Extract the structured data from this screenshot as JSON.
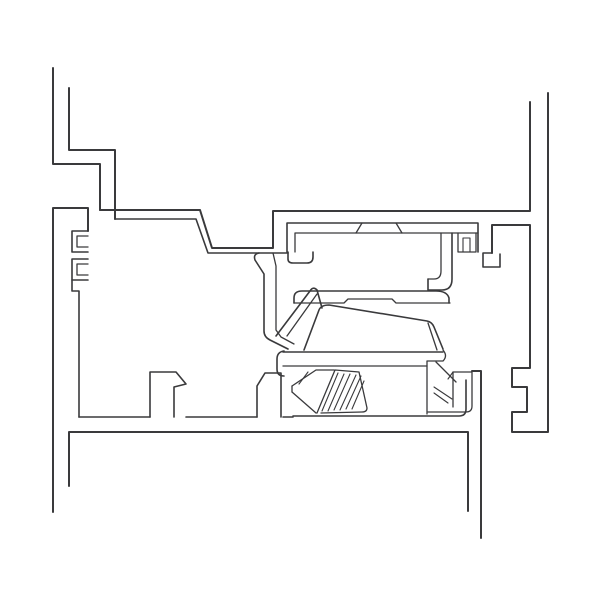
{
  "page": {
    "title": "",
    "background_color": "#ffffff"
  },
  "drawing": {
    "description-name": "window-frame-cross-section",
    "background": "#ffffff",
    "stroke_color": "#3a3a3c",
    "default_stroke_width": 1.7,
    "canvas": {
      "width": 600,
      "height": 600
    },
    "paths": [
      {
        "name": "sash-top-left-outer-wall",
        "d": "M53,68 V164 H100 V210",
        "w": 2
      },
      {
        "name": "sash-top-left-inner-wall",
        "d": "M69,88 V150 H115 V219",
        "w": 2
      },
      {
        "name": "sash-shelf-top-surface",
        "d": "M100,210 H200 L212,248 H273 V211 H530 V102",
        "w": 2
      },
      {
        "name": "sash-shelf-bottom-surface",
        "d": "M115,219 H196 L208,253 H288",
        "w": 1.6
      },
      {
        "name": "frame-left-outer-wall",
        "d": "M53,512 V208 H88 V231",
        "w": 2
      },
      {
        "name": "frame-left-screw-channel-upper",
        "d": "M88,231 H72 V252 H88",
        "w": 1.6
      },
      {
        "name": "frame-left-screw-channel-upper-inner",
        "d": "M88,247 H77 V236 H88",
        "w": 1.3
      },
      {
        "name": "frame-left-screw-channel-lower",
        "d": "M88,259 H72 V280 H88",
        "w": 1.6
      },
      {
        "name": "frame-left-screw-channel-lower-inner",
        "d": "M88,275 H77 V264 H88",
        "w": 1.3
      },
      {
        "name": "frame-left-web",
        "d": "M72,280 V291 H79 V417",
        "w": 1.6
      },
      {
        "name": "frame-bottom-floor",
        "d": "M79,417 H150 M186,417 H257 M283,417 H293",
        "w": 1.6
      },
      {
        "name": "glazing-tab-left",
        "d": "M150,417 V372 H176 L186,384 L174,387 V417",
        "w": 1.6
      },
      {
        "name": "glazing-tab-right",
        "d": "M257,417 V386 L265,373 H281 V417",
        "w": 1.6
      },
      {
        "name": "sill-bottom-profile",
        "d": "M69,486 V432 H468 V511",
        "w": 2
      },
      {
        "name": "frame-right-outer-wall",
        "d": "M548,93 V432 H512 V412 H527 V387 H512 V368 H530 V225 H492 V253",
        "w": 2
      },
      {
        "name": "frame-right-foot",
        "d": "M492,253 H483 V267 H500 V254",
        "w": 1.6
      },
      {
        "name": "keeper-plate-outline",
        "d": "M287,252 V223 H478 V252",
        "w": 1.6
      },
      {
        "name": "keeper-plate-underside",
        "d": "M295,252 V233 H478",
        "w": 1.3
      },
      {
        "name": "keeper-plate-pad",
        "d": "M356,233 L362,223 M396,223 L402,233",
        "w": 1.3
      },
      {
        "name": "keeper-lip",
        "d": "M288,252 V259 Q288,263 293,263 H307 Q313,263 313,257 V252",
        "w": 1.6
      },
      {
        "name": "keeper-screw-boss",
        "d": "M458,233 V252 H476 V233",
        "w": 1.3
      },
      {
        "name": "keeper-screw-boss-inner",
        "d": "M463,252 V238 H470 V252",
        "w": 1.1
      },
      {
        "name": "keeper-hook-outer",
        "d": "M452,233 V279 Q452,290 442,290 H428 V279",
        "w": 1.6
      },
      {
        "name": "keeper-hook-inner",
        "d": "M441,233 V271 Q441,279 434,279 H428",
        "w": 1.3
      },
      {
        "name": "lock-cover-top",
        "d": "M294,303 V298 Q294,291 302,291 H436 Q447,291 449,298 V303",
        "w": 1.6
      },
      {
        "name": "lock-cover-bottom-edge",
        "d": "M294,303 H344 L348,299 H392 L396,303 H450",
        "w": 1.3
      },
      {
        "name": "lock-arm-outer",
        "d": "M259,253 Q253,254 255,260 L264,274 V331 Q264,337 270,340 L288,349",
        "w": 1.6
      },
      {
        "name": "lock-arm-inner",
        "d": "M273,253 L276,266 V330 L281,337 L294,344",
        "w": 1.3
      },
      {
        "name": "latch-hook-edge",
        "d": "M276,336 L310,291 Q313,286 317,290 L322,308",
        "w": 1.6
      },
      {
        "name": "latch-hook-inner-edge",
        "d": "M287,336 L317,294",
        "w": 1.3
      },
      {
        "name": "latch-bolt",
        "d": "M304,350 L319,310 Q321,305 329,305 L427,321 Q432,322 434,327 L443,349",
        "w": 1.6
      },
      {
        "name": "latch-bolt-edge-line",
        "d": "M428,323 L437,350",
        "w": 1.3
      },
      {
        "name": "lock-base-top",
        "d": "M283,352 H443",
        "w": 1.6
      },
      {
        "name": "lock-base-lower",
        "d": "M283,366 H427",
        "w": 1.3
      },
      {
        "name": "lock-base-left-cap",
        "d": "M284,351 Q277,352 277,359 V369 Q277,376 284,376",
        "w": 1.6
      },
      {
        "name": "wedge-upper-edge",
        "d": "M292,386 L316,370 H334",
        "w": 1.3
      },
      {
        "name": "wedge-lower-edge",
        "d": "M292,392 L316,413",
        "w": 1.3
      },
      {
        "name": "wedge-tip",
        "d": "M292,386 V392",
        "w": 1.3
      },
      {
        "name": "wedge-inner-line",
        "d": "M299,384 L308,372",
        "w": 1.1
      },
      {
        "name": "hatch-block-outline",
        "d": "M317,413 L335,370 L359,372 L367,408 Q367,412 362,412 L321,413",
        "w": 1.3
      },
      {
        "name": "hatch-lines",
        "d": "M322,411 L338,373 M328,411 L344,374 M334,410 L350,374 M340,410 L356,375 M346,409 L361,376 M352,409 L364,381",
        "w": 1.1
      },
      {
        "name": "bolt-landing",
        "d": "M443,350 Q448,356 443,361 H427 V414",
        "w": 1.3
      },
      {
        "name": "support-diagonal-edge",
        "d": "M436,362 L456,382",
        "w": 1.3
      },
      {
        "name": "support-hatch-1",
        "d": "M434,387 L452,399",
        "w": 1.1
      },
      {
        "name": "support-hatch-2",
        "d": "M434,393 L448,403",
        "w": 1.1
      },
      {
        "name": "support-flag",
        "d": "M453,407 V372 H472 V406 Q472,412 466,412 H428",
        "w": 1.3
      },
      {
        "name": "support-flag-step",
        "d": "M453,372 L448,379",
        "w": 1.1
      },
      {
        "name": "lock-bottom-plate",
        "d": "M293,416 H459 Q466,416 466,409 V380",
        "w": 1.6
      },
      {
        "name": "frame-right-ledge",
        "d": "M472,371 H481 V538",
        "w": 2
      }
    ]
  }
}
